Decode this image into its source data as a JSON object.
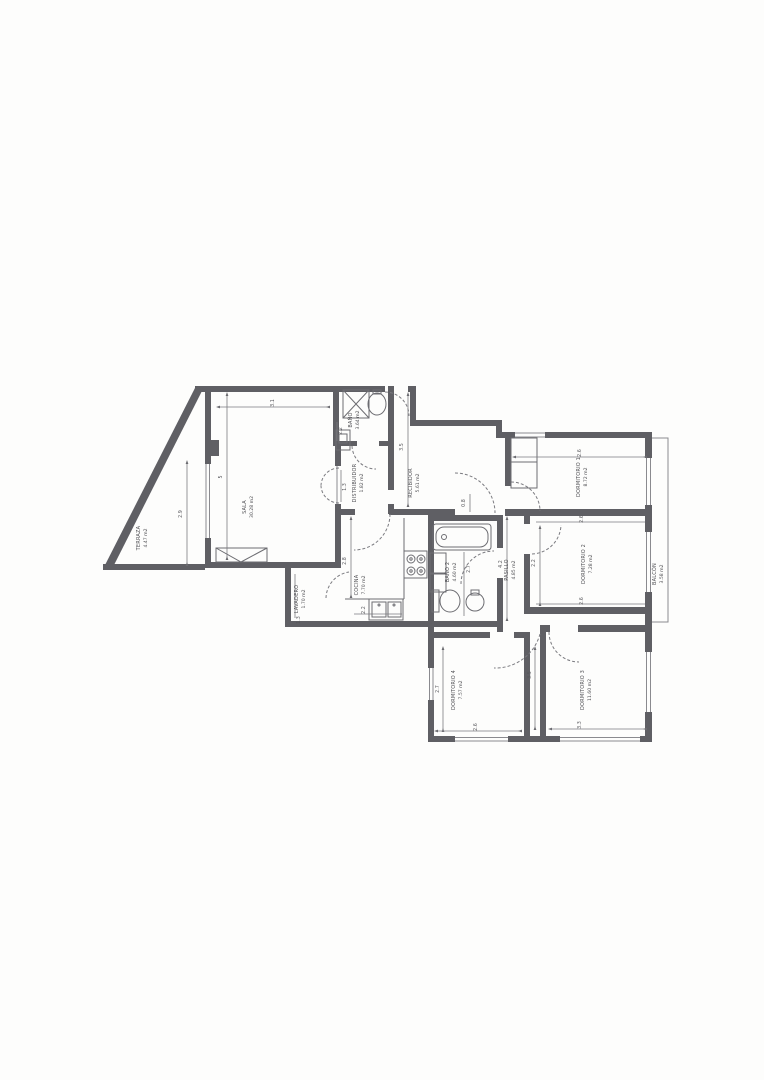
{
  "page": {
    "background": "#fdfdfc",
    "wall_color": "#5f5f64",
    "line_color": "#77777c",
    "text_color": "#4f4f53"
  },
  "rooms": [
    {
      "id": "terraza",
      "name": "TERRAZA",
      "area": "4.47 m2"
    },
    {
      "id": "sala",
      "name": "SALA",
      "area": "30.28 m2"
    },
    {
      "id": "bano",
      "name": "BAÑO",
      "area": "3.64 m2"
    },
    {
      "id": "distribuidor",
      "name": "DISTRIBUIDOR",
      "area": "1.82 m2"
    },
    {
      "id": "recibidor",
      "name": "RECIBIDOR",
      "area": "5.61 m2"
    },
    {
      "id": "cocina",
      "name": "COCINA",
      "area": "7.70 m2"
    },
    {
      "id": "lavadero",
      "name": "LAVADERO",
      "area": "1.70 m2"
    },
    {
      "id": "bano-2",
      "name": "BAÑO 2",
      "area": "4.60 m2"
    },
    {
      "id": "pasillo",
      "name": "PASILLO",
      "area": "4.85 m2"
    },
    {
      "id": "dormitorio-1",
      "name": "DORMITORIO 1",
      "area": "8.72 m2"
    },
    {
      "id": "dormitorio-2",
      "name": "DORMITORIO 2",
      "area": "7.28 m2"
    },
    {
      "id": "dormitorio-3",
      "name": "DORMITORIO 3",
      "area": "11.60 m2"
    },
    {
      "id": "dormitorio-4",
      "name": "DORMITORIO 4",
      "area": "7.57 m2"
    },
    {
      "id": "balcon",
      "name": "BALCÓN",
      "area": "3.58 m2"
    }
  ],
  "dimensions": [
    {
      "text": "3.1"
    },
    {
      "text": "5"
    },
    {
      "text": "2.9"
    },
    {
      "text": "2.2"
    },
    {
      "text": "1.3"
    },
    {
      "text": "3.5"
    },
    {
      "text": "0.8"
    },
    {
      "text": "2.8"
    },
    {
      "text": "2.2"
    },
    {
      "text": "1.3"
    },
    {
      "text": "2.7"
    },
    {
      "text": "4.2"
    },
    {
      "text": "2.2"
    },
    {
      "text": "2.6"
    },
    {
      "text": "2.6"
    },
    {
      "text": "2.6"
    },
    {
      "text": "3.5"
    },
    {
      "text": "2.7"
    },
    {
      "text": "2.6"
    },
    {
      "text": "3.3"
    }
  ]
}
